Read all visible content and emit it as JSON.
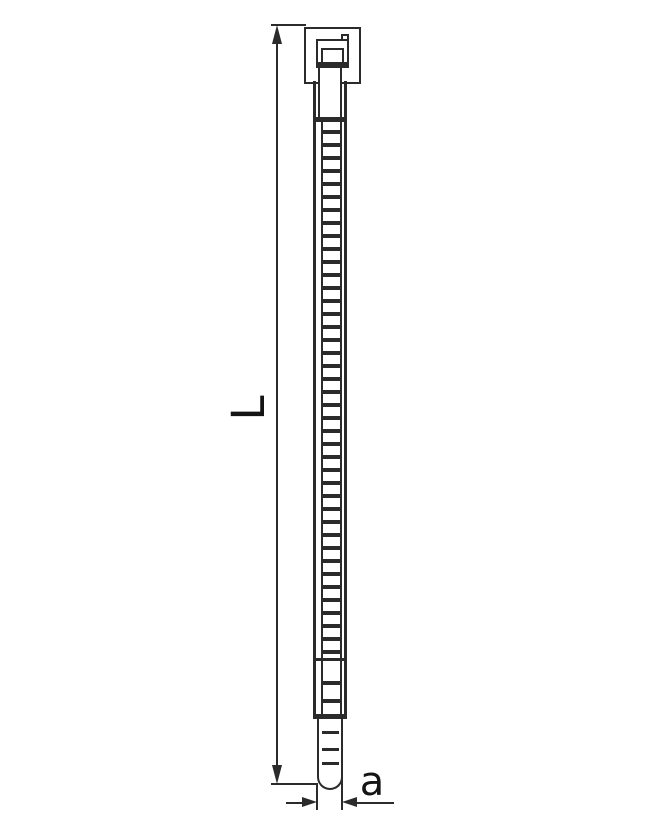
{
  "dimension_labels": {
    "length": "L",
    "width": "a"
  },
  "colors": {
    "line": "#2b2b2b",
    "label": "#141414",
    "background": "#ffffff"
  }
}
